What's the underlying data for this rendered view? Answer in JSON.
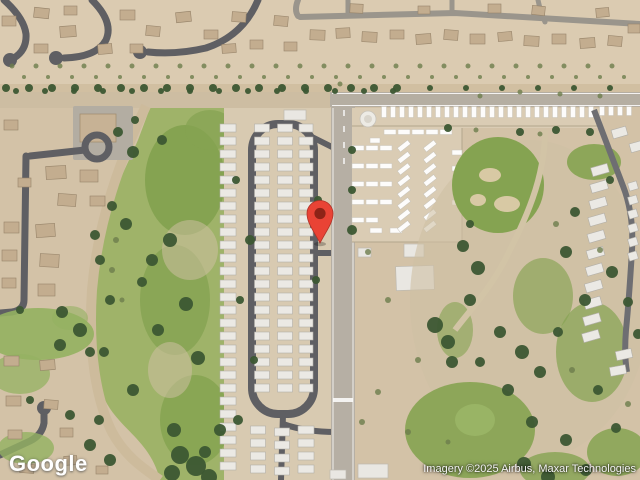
{
  "meta": {
    "width": 640,
    "height": 480,
    "view": "satellite"
  },
  "branding": {
    "logo_text": "Google"
  },
  "attribution": {
    "text": "Imagery ©2025 Airbus, Maxar Technologies"
  },
  "marker": {
    "label": "location-pin",
    "color": "#E94335",
    "inner_color": "#8E2317",
    "outline": "#B03227",
    "x": 320,
    "y": 243
  },
  "palette": {
    "desert": "#d3c2a7",
    "desertLight": "#dbcbb1",
    "desertDark": "#c6b496",
    "roadDark": "#5f5f63",
    "roadMid": "#8f8b85",
    "roadPale": "#b6afa4",
    "dirt": "#cdbb9c",
    "golf": "#85a351",
    "golfLight": "#9fb369",
    "lawn": "#94b161",
    "tree": "#3c5733",
    "bush": "#6d7d4c",
    "home": "#ebe9e4",
    "homeEdge": "#b2afa8",
    "house": "#c3ad8f",
    "houseEdge": "#97846a",
    "lotGround": "#daccb4",
    "building": "#e9e7e2",
    "white": "#ffffff"
  },
  "features": {
    "houses": {
      "shape": "rect",
      "fill": "house",
      "stroke": "houseEdge",
      "sw": 0.6,
      "items": [
        [
          2,
          16,
          14,
          10,
          0
        ],
        [
          34,
          8,
          15,
          10,
          6
        ],
        [
          64,
          6,
          13,
          9,
          0
        ],
        [
          60,
          26,
          16,
          11,
          -4
        ],
        [
          34,
          44,
          14,
          9,
          0
        ],
        [
          98,
          44,
          14,
          10,
          -5
        ],
        [
          120,
          10,
          15,
          10,
          0
        ],
        [
          130,
          44,
          13,
          9,
          0
        ],
        [
          146,
          26,
          14,
          10,
          5
        ],
        [
          176,
          12,
          15,
          10,
          -6
        ],
        [
          204,
          30,
          14,
          9,
          0
        ],
        [
          222,
          44,
          14,
          9,
          -4
        ],
        [
          232,
          12,
          14,
          10,
          4
        ],
        [
          250,
          40,
          13,
          9,
          0
        ],
        [
          274,
          16,
          14,
          10,
          5
        ],
        [
          284,
          42,
          13,
          9,
          0
        ],
        [
          310,
          30,
          15,
          10,
          2
        ],
        [
          336,
          28,
          14,
          10,
          -3
        ],
        [
          362,
          32,
          15,
          10,
          3
        ],
        [
          390,
          30,
          14,
          9,
          0
        ],
        [
          416,
          34,
          15,
          10,
          -4
        ],
        [
          444,
          30,
          14,
          10,
          4
        ],
        [
          470,
          34,
          15,
          10,
          0
        ],
        [
          498,
          32,
          14,
          9,
          -5
        ],
        [
          524,
          36,
          15,
          10,
          3
        ],
        [
          552,
          34,
          14,
          10,
          0
        ],
        [
          580,
          38,
          15,
          10,
          -4
        ],
        [
          608,
          36,
          14,
          10,
          5
        ],
        [
          350,
          4,
          13,
          9,
          3
        ],
        [
          418,
          6,
          12,
          8,
          0
        ],
        [
          488,
          4,
          13,
          9,
          0
        ],
        [
          532,
          6,
          13,
          9,
          6
        ],
        [
          596,
          8,
          13,
          9,
          -5
        ],
        [
          628,
          24,
          12,
          9,
          0
        ],
        [
          4,
          120,
          14,
          10,
          0
        ],
        [
          46,
          166,
          20,
          13,
          -3
        ],
        [
          80,
          170,
          18,
          12,
          0
        ],
        [
          18,
          178,
          13,
          9,
          0
        ],
        [
          58,
          194,
          18,
          12,
          4
        ],
        [
          90,
          196,
          15,
          10,
          0
        ],
        [
          4,
          222,
          15,
          11,
          0
        ],
        [
          36,
          224,
          19,
          13,
          -4
        ],
        [
          2,
          250,
          15,
          11,
          0
        ],
        [
          40,
          254,
          19,
          13,
          3
        ],
        [
          2,
          278,
          14,
          10,
          0
        ],
        [
          38,
          284,
          17,
          12,
          0
        ],
        [
          4,
          356,
          15,
          10,
          0
        ],
        [
          40,
          360,
          15,
          10,
          -4
        ],
        [
          6,
          396,
          15,
          10,
          0
        ],
        [
          44,
          400,
          14,
          9,
          4
        ],
        [
          8,
          430,
          14,
          9,
          0
        ],
        [
          60,
          428,
          13,
          9,
          0
        ],
        [
          20,
          464,
          14,
          9,
          4
        ],
        [
          64,
          456,
          13,
          9,
          -4
        ],
        [
          96,
          466,
          12,
          8,
          0
        ]
      ]
    },
    "park_homes": {
      "shape": "rect",
      "fill": "home",
      "stroke": "homeEdge",
      "sw": 0.6,
      "rows": [
        {
          "x": 228,
          "y": 128,
          "w": 16,
          "h": 8,
          "n": 27,
          "dy": 13
        },
        {
          "x": 262,
          "y": 128,
          "w": 15,
          "h": 8,
          "n": 21,
          "dy": 13
        },
        {
          "x": 285,
          "y": 128,
          "w": 15,
          "h": 8,
          "n": 21,
          "dy": 13
        },
        {
          "x": 306,
          "y": 128,
          "w": 14,
          "h": 8,
          "n": 21,
          "dy": 13
        },
        {
          "x": 258,
          "y": 430,
          "w": 15,
          "h": 8,
          "n": 4,
          "dy": 13
        },
        {
          "x": 282,
          "y": 432,
          "w": 15,
          "h": 8,
          "n": 4,
          "dy": 13
        },
        {
          "x": 306,
          "y": 430,
          "w": 16,
          "h": 8,
          "n": 4,
          "dy": 13
        }
      ]
    },
    "rvs": {
      "shape": "rect",
      "fill": "white",
      "stroke": "#c7c3ba",
      "sw": 0.5,
      "opacity": 0.95,
      "rows": [
        {
          "x": 384,
          "y": 112,
          "w": 5,
          "h": 11,
          "n": 24,
          "dx": 9
        },
        {
          "x": 602,
          "y": 111,
          "w": 5,
          "h": 9,
          "n": 4,
          "dx": 9
        },
        {
          "x": 390,
          "y": 132,
          "w": 12,
          "h": 5,
          "n": 5,
          "dx": 14
        },
        {
          "x": 358,
          "y": 148,
          "w": 12,
          "h": 5,
          "n": 3,
          "dx": 14
        },
        {
          "x": 358,
          "y": 166,
          "w": 12,
          "h": 5,
          "n": 3,
          "dx": 14
        },
        {
          "x": 358,
          "y": 184,
          "w": 12,
          "h": 5,
          "n": 3,
          "dx": 14
        },
        {
          "x": 358,
          "y": 202,
          "w": 12,
          "h": 5,
          "n": 3,
          "dx": 14
        },
        {
          "x": 358,
          "y": 220,
          "w": 12,
          "h": 5,
          "n": 2,
          "dx": 14
        },
        {
          "x": 404,
          "y": 146,
          "w": 13,
          "h": 5,
          "rot": -38,
          "n": 8,
          "dy": 11.5
        },
        {
          "x": 430,
          "y": 146,
          "w": 13,
          "h": 5,
          "rot": -38,
          "n": 8,
          "dy": 11.5
        }
      ],
      "items": [
        [
          370,
          138,
          10,
          5,
          0
        ],
        [
          452,
          150,
          10,
          5,
          0
        ],
        [
          452,
          166,
          10,
          5,
          0
        ],
        [
          452,
          200,
          10,
          5,
          0
        ],
        [
          370,
          228,
          12,
          5,
          0
        ],
        [
          390,
          228,
          12,
          5,
          0
        ]
      ]
    },
    "buildings": {
      "shape": "rect",
      "fill": "building",
      "stroke": "#bdb9b0",
      "sw": 0.7,
      "items": [
        [
          396,
          266,
          38,
          24,
          -2
        ],
        [
          404,
          244,
          20,
          13,
          0
        ],
        [
          358,
          248,
          13,
          9,
          0
        ],
        [
          358,
          464,
          30,
          14,
          0
        ],
        [
          284,
          110,
          22,
          10,
          0
        ],
        [
          330,
          470,
          16,
          9,
          0
        ]
      ]
    },
    "edge_homes": {
      "shape": "rect",
      "fill": "home",
      "stroke": "homeEdge",
      "sw": 0.6,
      "rows": [
        {
          "x": 600,
          "y": 170,
          "w": 17,
          "h": 9,
          "rot": -16,
          "n": 11,
          "dx": -0.9,
          "dy": 16.6
        },
        {
          "x": 633,
          "y": 186,
          "w": 9,
          "h": 8,
          "rot": -16,
          "n": 6,
          "dy": 14
        }
      ],
      "items": [
        [
          612,
          128,
          15,
          9,
          -16
        ],
        [
          630,
          142,
          14,
          9,
          -16
        ],
        [
          616,
          350,
          16,
          9,
          -12
        ],
        [
          610,
          366,
          16,
          9,
          -10
        ]
      ]
    },
    "bushes": {
      "shape": "circle",
      "fill": "bush",
      "opacity": 0.8,
      "rows": [
        {
          "x": 12,
          "y": 66,
          "r": 2.5,
          "n": 26,
          "dx": 24
        },
        {
          "x": 24,
          "y": 77,
          "r": 2,
          "n": 26,
          "dx": 24
        }
      ],
      "items": [
        [
          116,
          240,
          3
        ],
        [
          112,
          270,
          3
        ],
        [
          122,
          300,
          2.5
        ],
        [
          368,
          252,
          3
        ],
        [
          388,
          300,
          3
        ],
        [
          418,
          360,
          3
        ],
        [
          378,
          392,
          3
        ],
        [
          362,
          422,
          3
        ],
        [
          408,
          432,
          3
        ],
        [
          448,
          442,
          2.5
        ],
        [
          556,
          224,
          3
        ],
        [
          600,
          250,
          3
        ],
        [
          572,
          370,
          3
        ],
        [
          628,
          404,
          3
        ],
        [
          476,
          130,
          2.5
        ],
        [
          540,
          134,
          2.5
        ],
        [
          340,
          84,
          2.5
        ],
        [
          600,
          96,
          2.5
        ],
        [
          480,
          96,
          2.5
        ],
        [
          520,
          92,
          2.5
        ],
        [
          560,
          94,
          2.5
        ]
      ]
    },
    "trees": {
      "shape": "circle",
      "fill": "tree",
      "opacity": 0.95,
      "rows": [
        {
          "x": 6,
          "y": 88,
          "r": 4,
          "n": 18,
          "dx": 23
        },
        {
          "x": 16,
          "y": 91,
          "r": 3,
          "n": 14,
          "dx": 29
        },
        {
          "x": 430,
          "y": 88,
          "r": 3,
          "n": 6,
          "dx": 36
        }
      ],
      "items": [
        [
          118,
          132,
          5
        ],
        [
          133,
          152,
          6
        ],
        [
          112,
          206,
          5
        ],
        [
          126,
          224,
          6
        ],
        [
          170,
          240,
          7
        ],
        [
          152,
          260,
          6
        ],
        [
          142,
          282,
          5
        ],
        [
          186,
          304,
          7
        ],
        [
          158,
          330,
          6
        ],
        [
          198,
          358,
          7
        ],
        [
          133,
          390,
          6
        ],
        [
          174,
          430,
          7
        ],
        [
          205,
          452,
          6
        ],
        [
          110,
          300,
          5
        ],
        [
          104,
          352,
          5
        ],
        [
          99,
          420,
          5
        ],
        [
          180,
          455,
          9
        ],
        [
          196,
          466,
          10
        ],
        [
          172,
          473,
          8
        ],
        [
          209,
          477,
          8
        ],
        [
          220,
          430,
          6
        ],
        [
          135,
          120,
          4
        ],
        [
          162,
          140,
          5
        ],
        [
          463,
          246,
          6
        ],
        [
          478,
          268,
          7
        ],
        [
          470,
          300,
          6
        ],
        [
          452,
          362,
          6
        ],
        [
          500,
          332,
          6
        ],
        [
          522,
          352,
          7
        ],
        [
          540,
          372,
          6
        ],
        [
          558,
          332,
          5
        ],
        [
          566,
          252,
          6
        ],
        [
          585,
          300,
          6
        ],
        [
          612,
          272,
          6
        ],
        [
          628,
          302,
          5
        ],
        [
          480,
          362,
          5
        ],
        [
          508,
          390,
          6
        ],
        [
          532,
          422,
          6
        ],
        [
          566,
          440,
          6
        ],
        [
          598,
          390,
          5
        ],
        [
          616,
          428,
          5
        ],
        [
          586,
          470,
          6
        ],
        [
          524,
          464,
          7
        ],
        [
          548,
          477,
          7
        ],
        [
          435,
          325,
          8
        ],
        [
          448,
          342,
          7
        ],
        [
          575,
          212,
          5
        ],
        [
          470,
          224,
          4
        ],
        [
          638,
          334,
          5
        ],
        [
          610,
          180,
          4
        ],
        [
          590,
          132,
          4
        ],
        [
          62,
          312,
          6
        ],
        [
          80,
          330,
          7
        ],
        [
          60,
          345,
          6
        ],
        [
          90,
          352,
          5
        ],
        [
          20,
          310,
          4
        ],
        [
          95,
          235,
          5
        ],
        [
          100,
          260,
          5
        ],
        [
          70,
          415,
          5
        ],
        [
          30,
          400,
          4
        ],
        [
          90,
          445,
          6
        ],
        [
          110,
          460,
          6
        ],
        [
          236,
          180,
          4
        ],
        [
          250,
          240,
          5
        ],
        [
          240,
          300,
          4
        ],
        [
          254,
          360,
          4
        ],
        [
          238,
          420,
          5
        ],
        [
          318,
          200,
          4
        ],
        [
          316,
          280,
          4
        ],
        [
          352,
          150,
          4
        ],
        [
          352,
          190,
          4
        ],
        [
          352,
          230,
          5
        ],
        [
          448,
          128,
          4
        ],
        [
          520,
          132,
          4
        ],
        [
          556,
          130,
          4
        ]
      ]
    }
  }
}
